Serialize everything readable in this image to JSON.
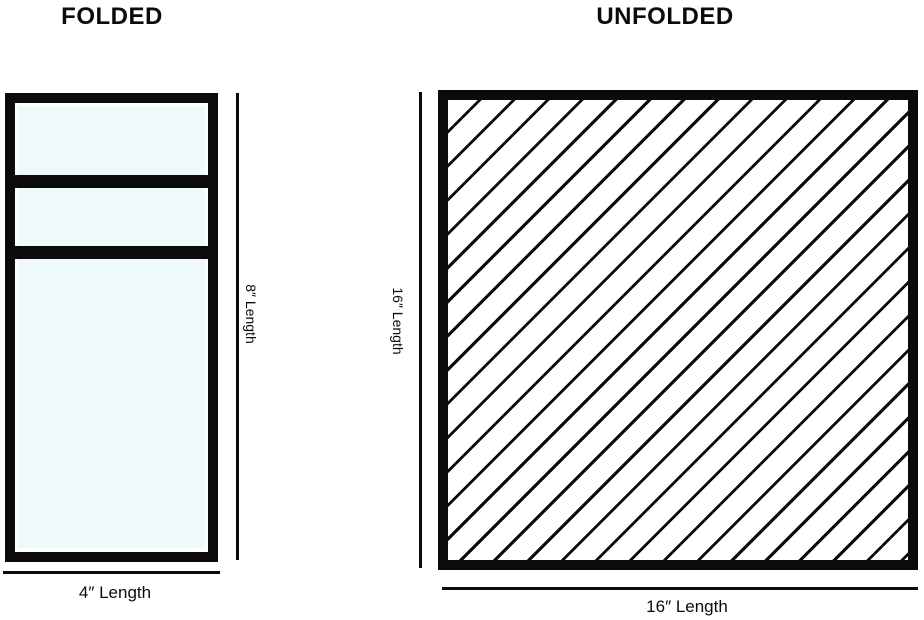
{
  "folded": {
    "title": "FOLDED",
    "height_label": "8″ Length",
    "width_label": "4″ Length"
  },
  "unfolded": {
    "title": "UNFOLDED",
    "height_label": "16″ Length",
    "width_label": "16″ Length"
  },
  "colors": {
    "ink": "#0b0b0b",
    "towel_fill": "#eff8fb",
    "background": "#ffffff"
  }
}
